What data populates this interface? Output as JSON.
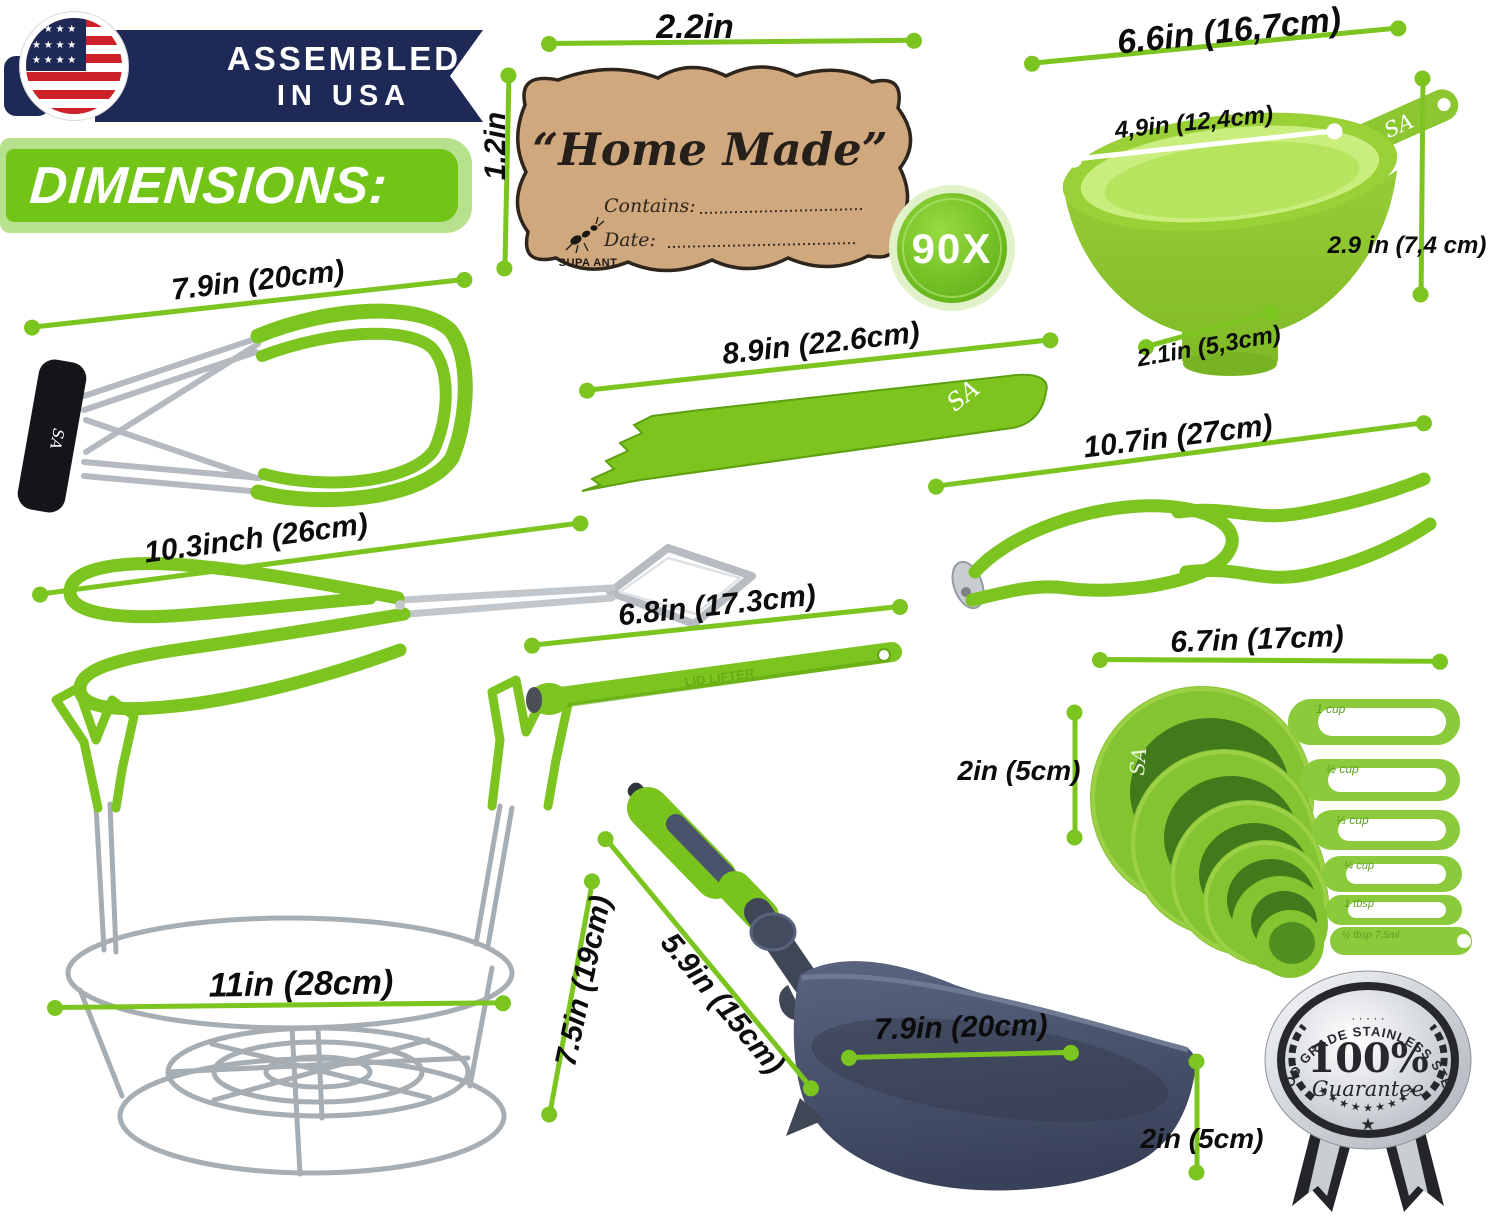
{
  "header": {
    "assembled_line1": "ASSEMBLED",
    "assembled_line2": "IN USA",
    "flag_stars_row": "★ ★ ★ ★",
    "dimensions_title": "DIMENSIONS:"
  },
  "label_card": {
    "title": "“Home Made”",
    "contains_label": "Contains:",
    "date_label": "Date:",
    "brand": "SUPA ANT",
    "quantity_badge": "90X"
  },
  "brand_marks": {
    "sa": "SA",
    "lid_lifter_embossed": "LID LIFTER"
  },
  "measurements": {
    "label_width": "2.2in",
    "label_height": "1.2in",
    "funnel_top": "6.6in (16,7cm)",
    "funnel_inner": "4,9in (12,4cm)",
    "funnel_height": "2.9 in (7,4 cm)",
    "funnel_base": "2.1in (5,3cm)",
    "jar_lifter": "7.9in (20cm)",
    "bubble_remover": "8.9in (22.6cm)",
    "jar_wrench": "10.7in (27cm)",
    "tongs": "10.3inch (26cm)",
    "lid_lifter": "6.8in (17.3cm)",
    "cups_width": "6.7in (17cm)",
    "cups_height": "2in (5cm)",
    "rack_diameter": "11in (28cm)",
    "rack_height": "7.5in (19cm)",
    "ladle_handle": "5.9in (15cm)",
    "ladle_width": "7.9in (20cm)",
    "ladle_depth": "2in (5cm)"
  },
  "cup_labels": [
    "1 cup",
    "½ cup",
    "⅓ cup",
    "¼ cup",
    "1 tbsp",
    "½ tbsp 7.5ml"
  ],
  "guarantee_badge": {
    "arc_text": "FOOD GRADE STAINLESS STEEL",
    "percent": "100%",
    "script_text": "Guarantee",
    "dots": "· · · · ·",
    "stars_arc": "★ ★ ★ ★ ★ ★ ★ ★ ★",
    "bottom_star": "★"
  },
  "colors": {
    "accent_green": "#76c117",
    "line_green": "#7cc41f",
    "banner_green": "#72c417",
    "banner_green_light": "#b7e18c",
    "navy": "#1e2a55",
    "flag_red": "#cc2128",
    "kraft": "#d0a87e",
    "steel_gray": "#a6adb3",
    "ladle_slate": "#475062",
    "badge_silver": "#c9cdd2"
  }
}
